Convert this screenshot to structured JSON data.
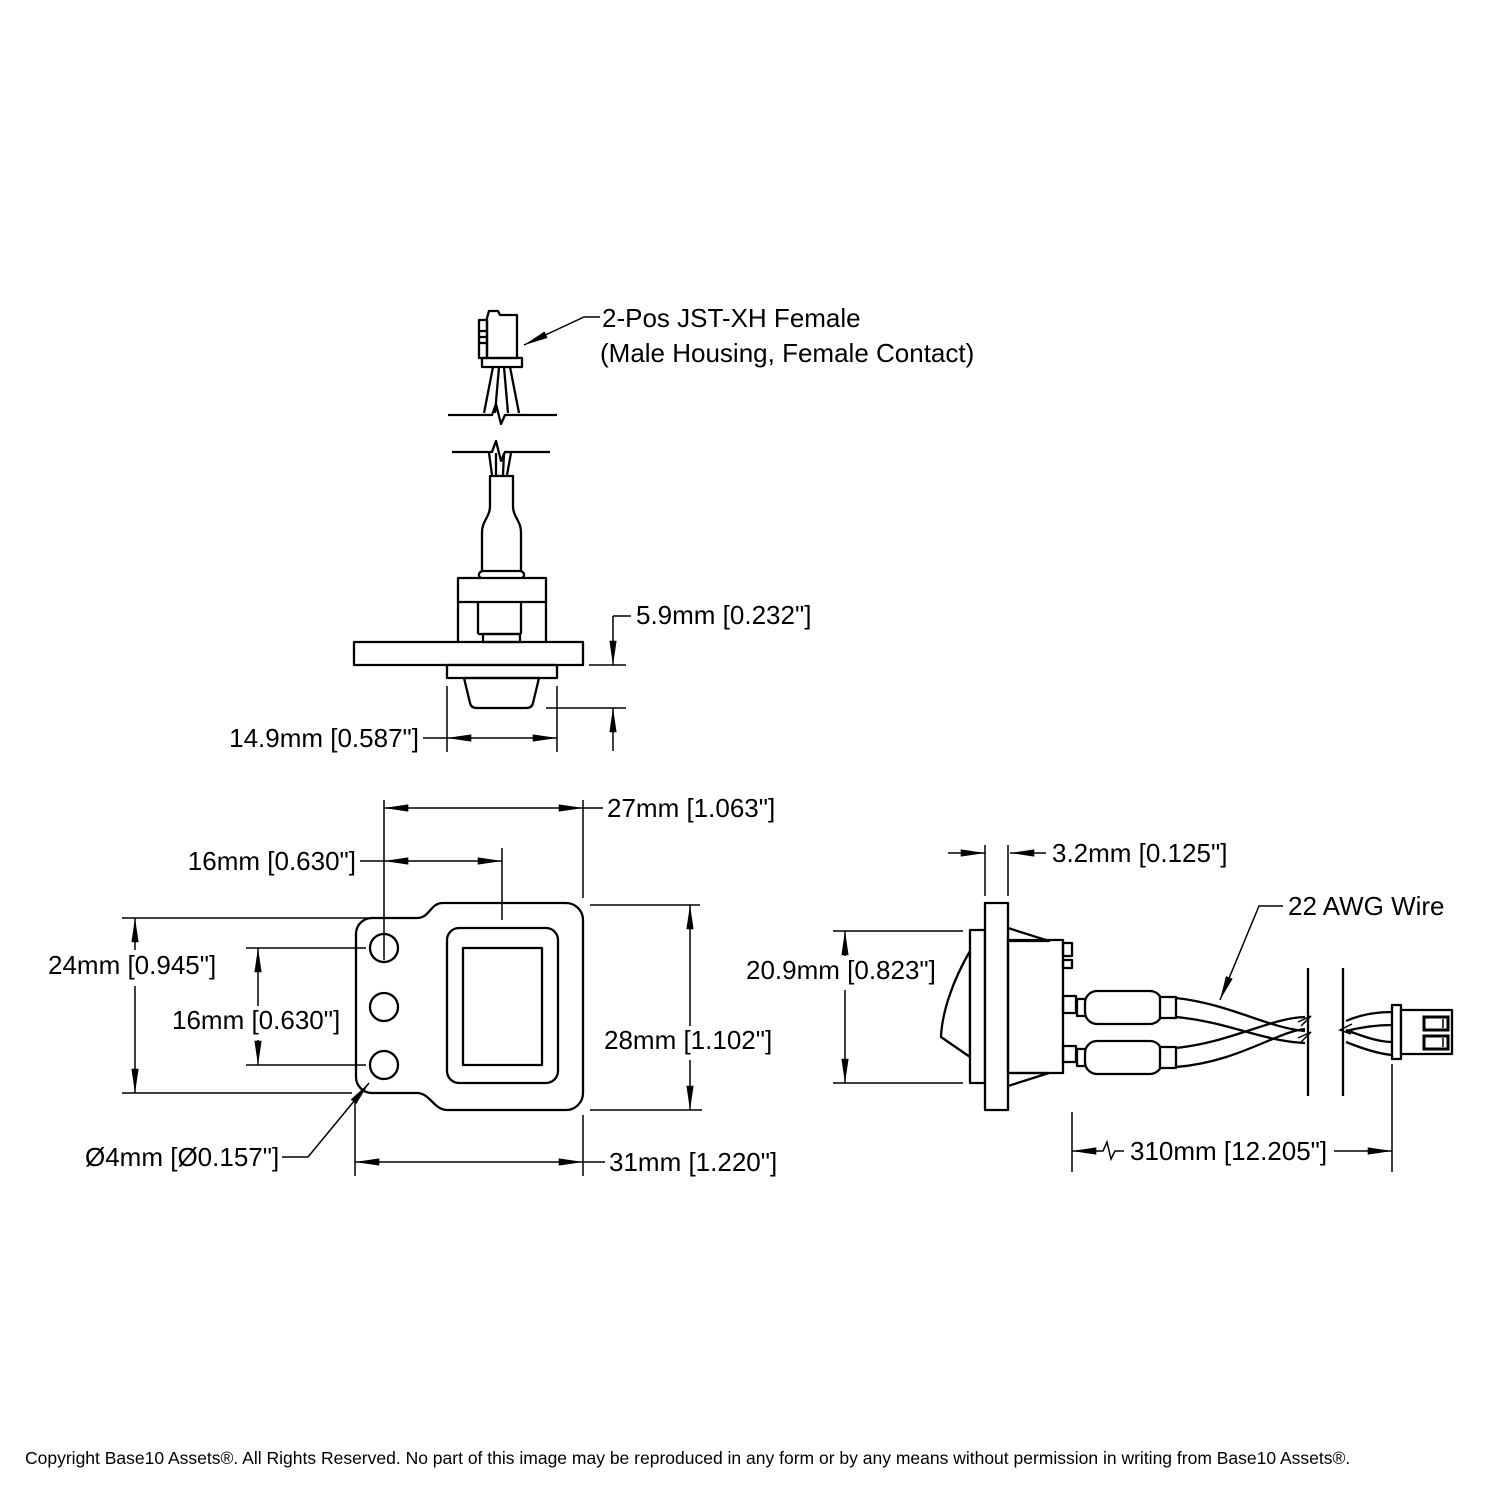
{
  "page": {
    "background": "#ffffff",
    "line_color": "#000000"
  },
  "callouts": {
    "connector_line1": "2-Pos JST-XH Female",
    "connector_line2": "(Male Housing, Female Contact)",
    "wire_gauge": "22 AWG Wire",
    "hole_diameter": "Ø4mm [Ø0.157\"]"
  },
  "top_view": {
    "dim_rocker_protrusion": "5.9mm [0.232\"]",
    "dim_rocker_width": "14.9mm [0.587\"]"
  },
  "front_view": {
    "dim_hole_to_edge": "27mm [1.063\"]",
    "dim_hole_to_center": "16mm [0.630\"]",
    "dim_tab_height": "24mm [0.945\"]",
    "dim_hole_span": "16mm [0.630\"]",
    "dim_body_height": "28mm [1.102\"]",
    "dim_overall_width": "31mm [1.220\"]"
  },
  "side_view": {
    "dim_panel_thickness": "3.2mm [0.125\"]",
    "dim_body_depth": "20.9mm [0.823\"]",
    "dim_wire_length": "310mm [12.205\"]"
  },
  "footer": {
    "copyright": "Copyright Base10 Assets®.  All Rights Reserved. No part of this image may be reproduced in any form or by any means without permission in writing from Base10 Assets®."
  }
}
